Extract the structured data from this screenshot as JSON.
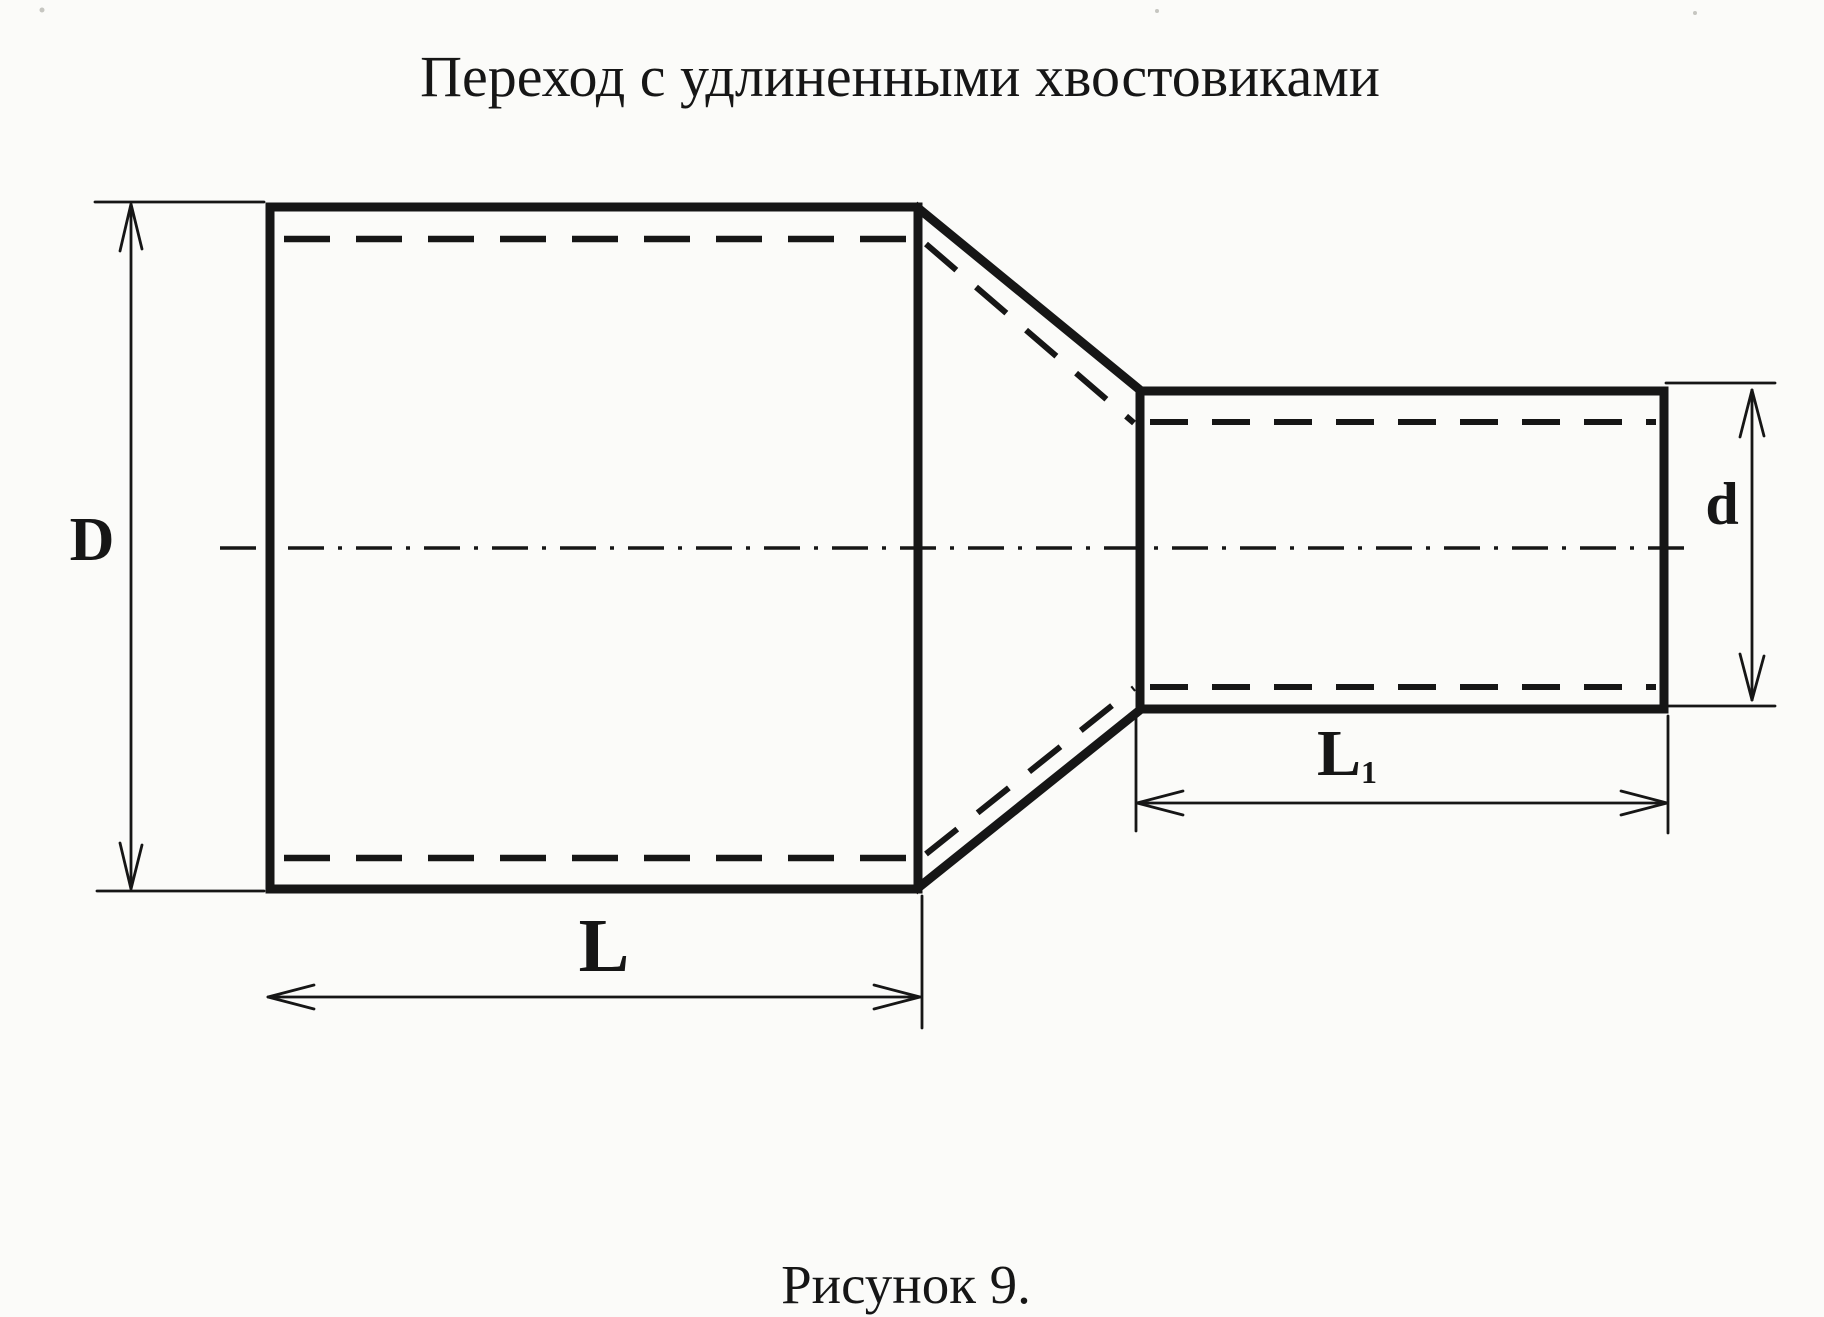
{
  "title": "Переход с удлиненными хвостовиками",
  "caption": "Рисунок 9.",
  "labels": {
    "big_diameter": "D",
    "small_diameter": "d",
    "big_length": "L",
    "small_length_base": "L",
    "small_length_sub": "1"
  },
  "colors": {
    "ink": "#161616",
    "paper": "#fbfbf9"
  }
}
